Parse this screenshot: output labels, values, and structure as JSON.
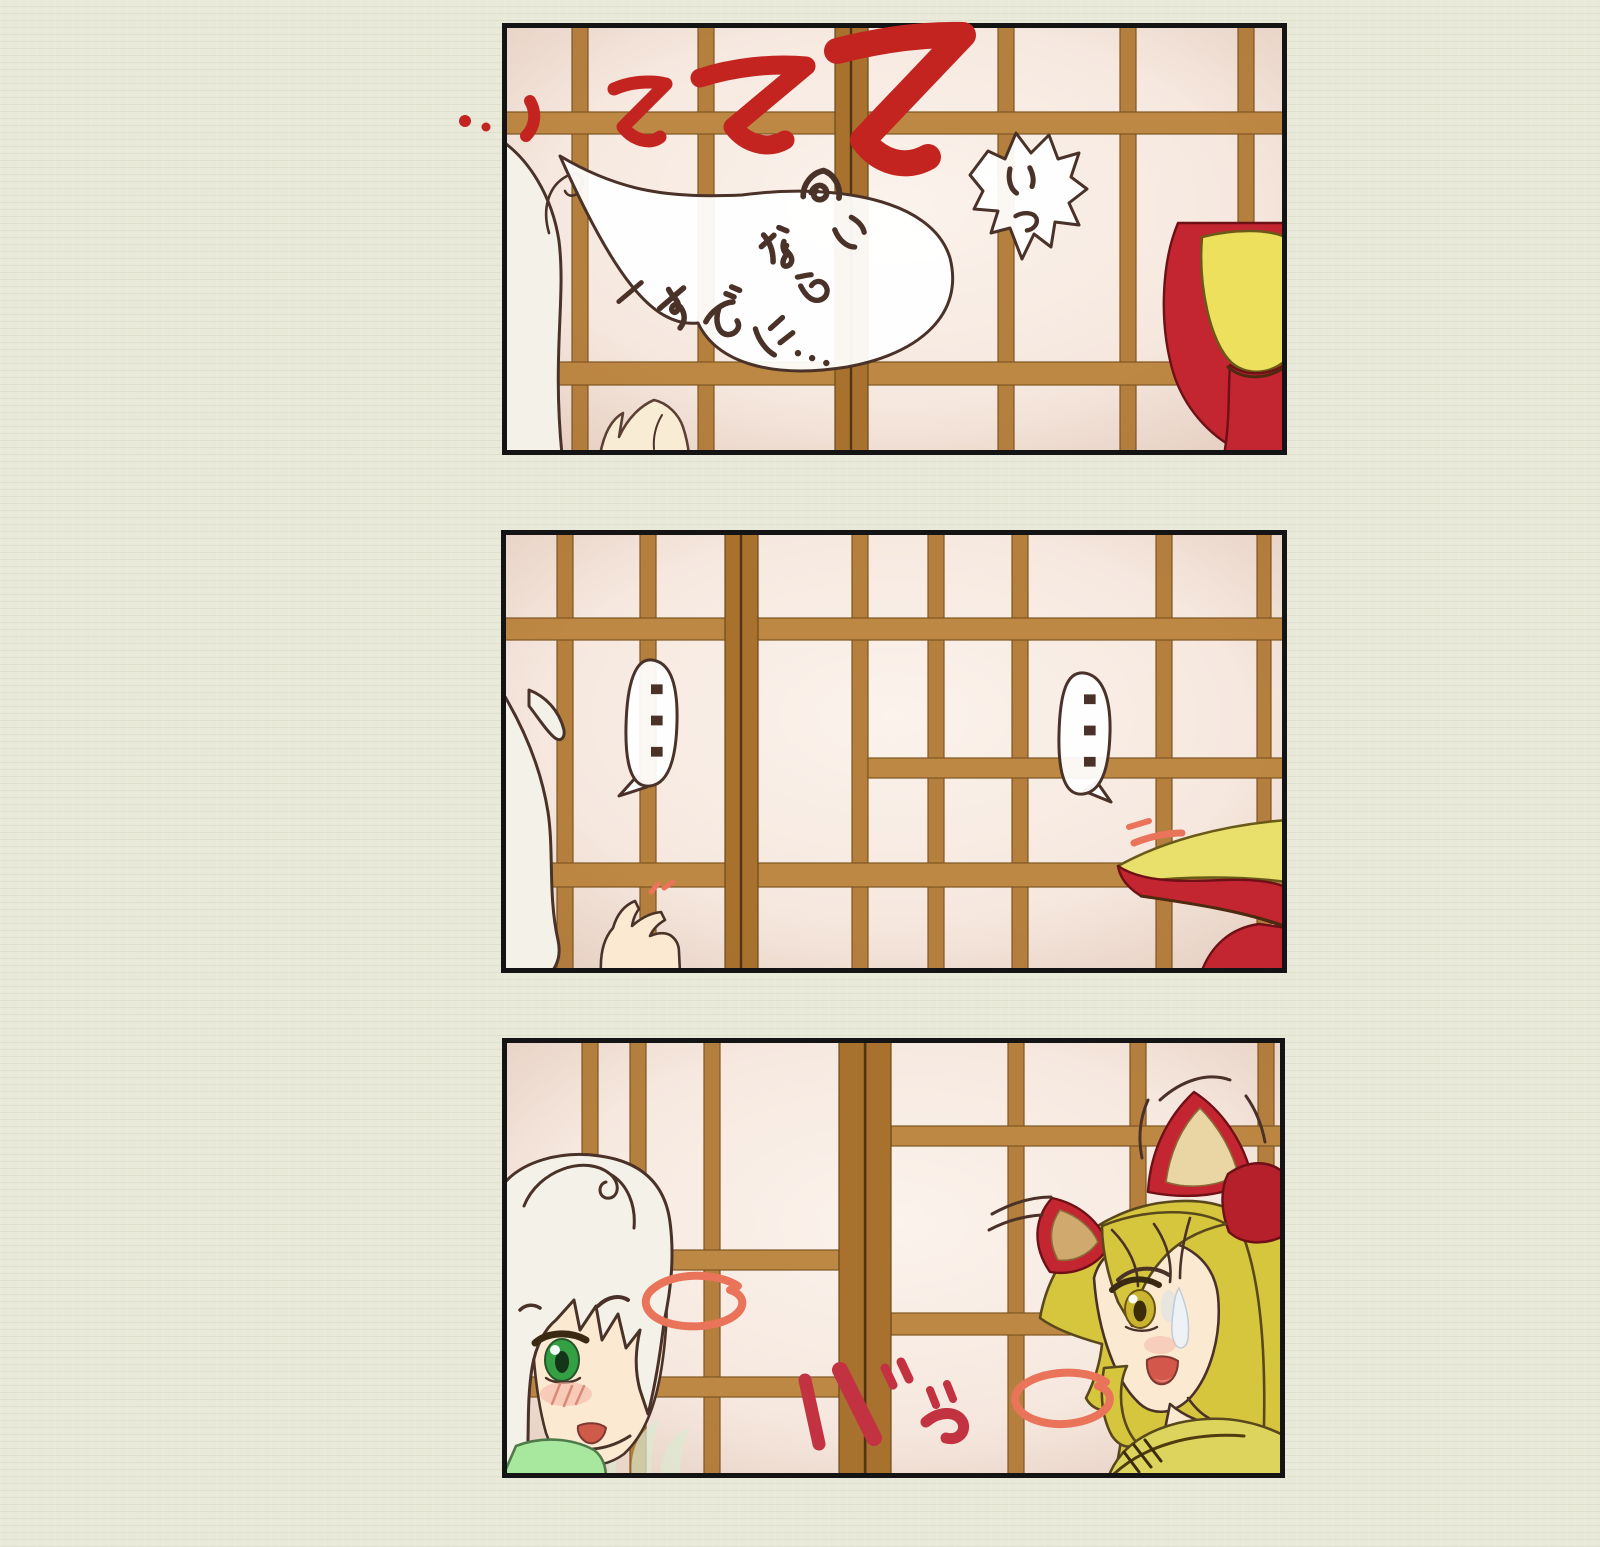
{
  "title": "Three-panel comic strip: two girls on either side of shoji sliding doors",
  "palette": {
    "bg": "#e8e9d9",
    "panel_border": "#141414",
    "paper": "#f8ece3",
    "wood": "#b5803e",
    "ink": "#4a3229",
    "marker_red": "#c42420",
    "sfx_red": "#c23240",
    "swirl_red": "#e9745a",
    "hair_white": "#f4f1e8",
    "hair_blonde": "#d6c63e",
    "skin": "#fbe9d2",
    "eye_green": "#33a043",
    "eye_yellow": "#c9b42f",
    "ear_red": "#c32630",
    "cloth_green": "#a8e79e",
    "cloth_yellow": "#ddd45e"
  },
  "panels": [
    {
      "name": "panel-1",
      "sfx": [
        {
          "id": "snore",
          "text": "ZZZ",
          "style": "red hand-drawn snore marks growing left to right, crossing the frame"
        }
      ],
      "bubbles": [
        {
          "id": "speech",
          "speaker": "sleeping white-haired girl",
          "text": "匂いなら すでに…"
        },
        {
          "id": "startle",
          "speaker": "fox-eared girl",
          "text": "いっ"
        }
      ],
      "characters": [
        {
          "id": "white-haired-girl",
          "visible": "white hair with curl along left edge, pale animal ear at bottom"
        },
        {
          "id": "fox-eared-girl",
          "visible": "yellow hood with red trim entering from right edge"
        }
      ]
    },
    {
      "name": "panel-2",
      "bubbles": [
        {
          "id": "silence-left",
          "speaker": "white-haired girl",
          "text": "…"
        },
        {
          "id": "silence-right",
          "speaker": "fox-eared girl",
          "text": "…"
        }
      ],
      "characters": [
        {
          "id": "white-haired-girl",
          "visible": "hair at left edge, hand reaching toward the door"
        },
        {
          "id": "fox-eared-girl",
          "visible": "yellow sleeve with red trim at lower right"
        }
      ]
    },
    {
      "name": "panel-3",
      "sfx": [
        {
          "id": "slide-open",
          "text": "バッ",
          "style": "red brush strokes at the door seam"
        }
      ],
      "characters": [
        {
          "id": "white-haired-girl",
          "visible": "surprised girl, white hair with ahoge, green eyes, blush, green collar"
        },
        {
          "id": "fox-eared-girl",
          "visible": "blonde girl, red fox-ear hat with bow, yellow eyes, sweat drop, yellow kimono"
        }
      ]
    }
  ]
}
